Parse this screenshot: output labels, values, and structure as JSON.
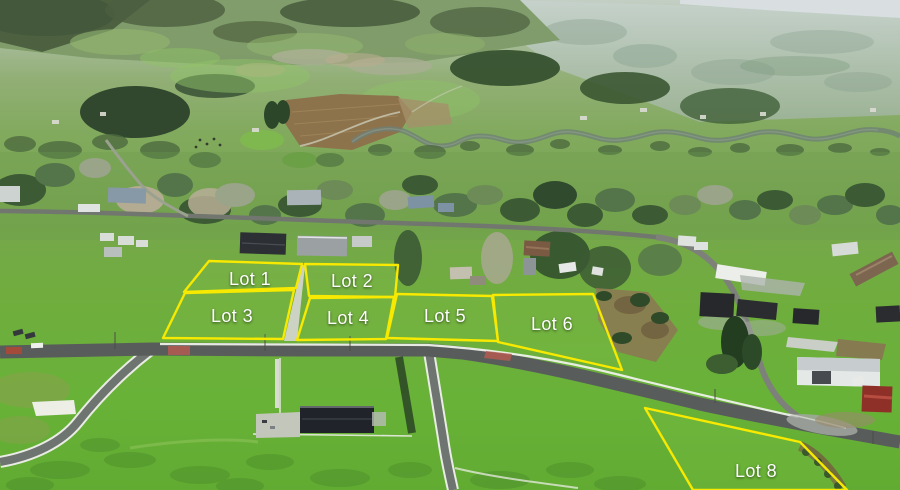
{
  "overlay": {
    "line_color": "#f7e900",
    "label_color": "#ffffff",
    "lots": [
      {
        "id": "1",
        "label": "Lot 1",
        "points": "209,261 302,264 296,288 184,292",
        "label_x": 250,
        "label_y": 285
      },
      {
        "id": "2",
        "label": "Lot 2",
        "points": "305,264 398,265 395,297 309,296",
        "label_x": 352,
        "label_y": 287
      },
      {
        "id": "3",
        "label": "Lot 3",
        "points": "185,293 294,290 283,339 163,338",
        "label_x": 232,
        "label_y": 322
      },
      {
        "id": "4",
        "label": "Lot 4",
        "points": "310,298 394,297 386,339 297,340",
        "label_x": 348,
        "label_y": 324
      },
      {
        "id": "5",
        "label": "Lot 5",
        "points": "397,294 492,296 498,341 387,338",
        "label_x": 445,
        "label_y": 322
      },
      {
        "id": "6",
        "label": "Lot 6",
        "points": "493,295 593,294 622,370 498,342",
        "label_x": 552,
        "label_y": 330
      },
      {
        "id": "8",
        "label": "Lot 8",
        "points": "645,408 800,442 847,490 693,490",
        "label_x": 756,
        "label_y": 477
      }
    ]
  }
}
